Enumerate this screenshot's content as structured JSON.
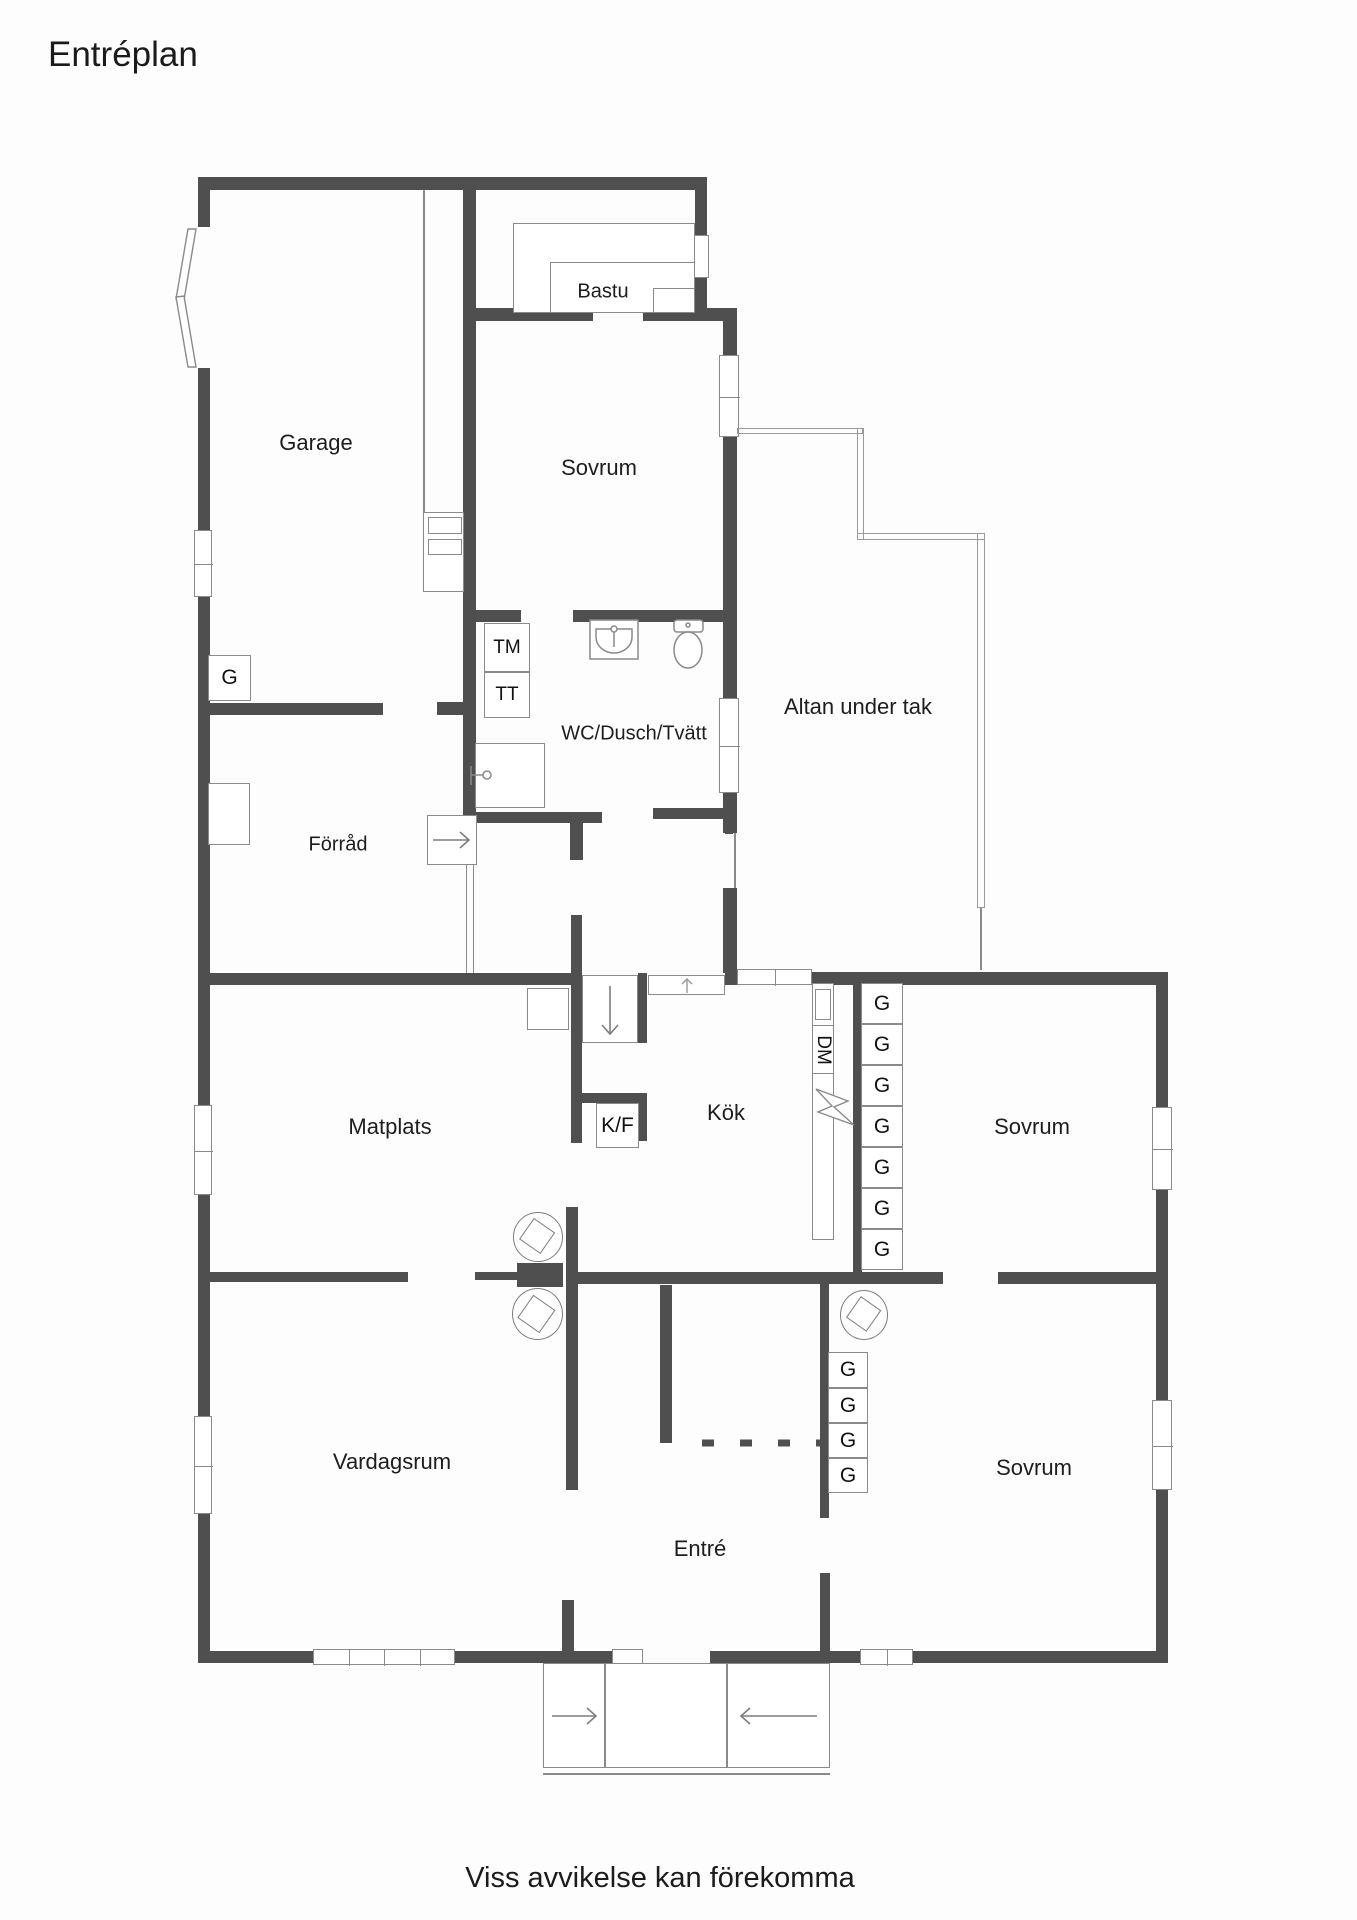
{
  "title": "Entréplan",
  "disclaimer": "Viss avvikelse kan förekomma",
  "rooms": {
    "garage": "Garage",
    "bastu": "Bastu",
    "sovrum_top": "Sovrum",
    "altan": "Altan under tak",
    "wc": "WC/Dusch/Tvätt",
    "forrad": "Förråd",
    "matplats": "Matplats",
    "kok": "Kök",
    "sovrum_right": "Sovrum",
    "vardagsrum": "Vardagsrum",
    "entre": "Entré",
    "sovrum_lower": "Sovrum"
  },
  "fixtures": {
    "tm": "TM",
    "tt": "TT",
    "kf": "K/F",
    "dm": "DM"
  },
  "closets": {
    "garage": "G",
    "upper": [
      "G",
      "G",
      "G",
      "G",
      "G",
      "G",
      "G"
    ],
    "lower": [
      "G",
      "G",
      "G",
      "G"
    ]
  },
  "colors": {
    "wall": "#4f4f4f",
    "thin_line": "#8a8a8a",
    "text": "#1d1d1d",
    "background": "#fdfdfd"
  }
}
